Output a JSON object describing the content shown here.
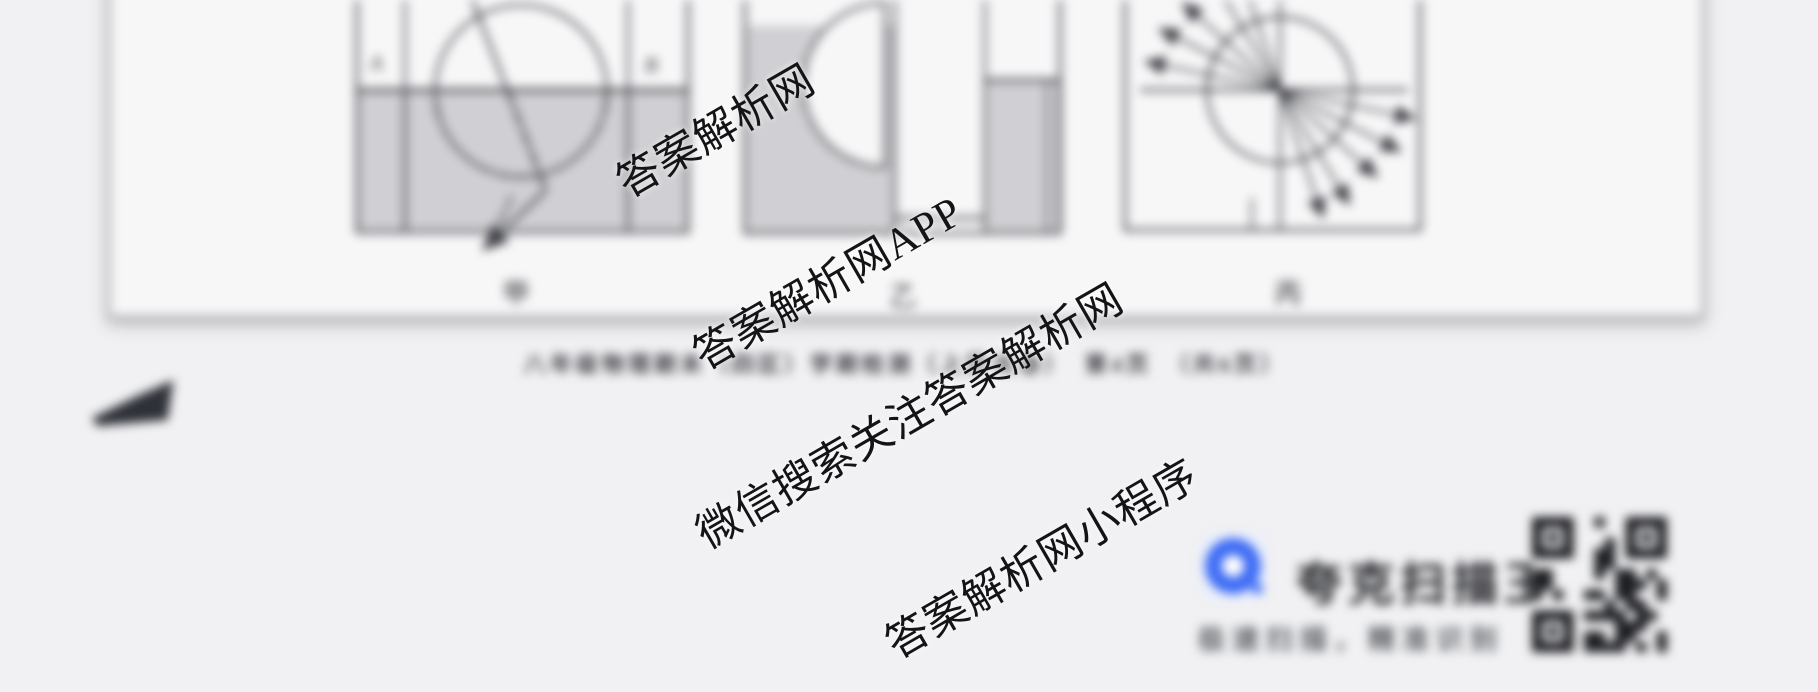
{
  "watermarks": {
    "wm1": "答案解析网",
    "wm2": "答案解析网APP",
    "wm3": "微信搜索关注答案解析网",
    "wm4": "答案解析网小程序"
  },
  "document": {
    "footer_caption": "八年级物理期末（四区）学期检测（上册试卷）　第4页　（共6页）",
    "figures": {
      "jia": "甲",
      "yi": "乙",
      "bing": "丙",
      "point_a": "A",
      "point_b": "B"
    }
  },
  "promo": {
    "brand_name": "夸克扫描王",
    "slogan": "极速扫描，精准识别",
    "logo_color": "#3e6cf4"
  }
}
